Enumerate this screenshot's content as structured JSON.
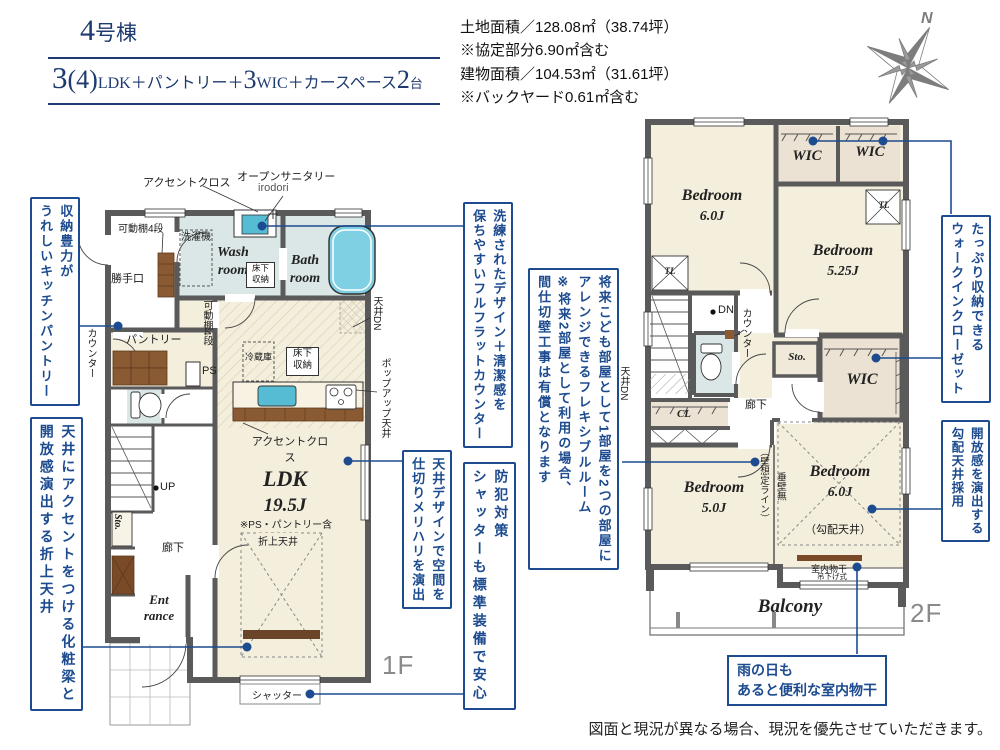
{
  "header": {
    "unit_number": "4",
    "unit_suffix": "号棟",
    "plan": {
      "n1": "3",
      "p": "(4)",
      "t1": "LDK＋パントリー＋",
      "n2": "3",
      "t2": "WIC＋カースペース",
      "n3": "2",
      "t3": "台"
    },
    "area_lines": [
      "土地面積／128.08㎡（38.74坪）",
      "※協定部分6.90㎡含む",
      "建物面積／104.53㎡（31.61坪）",
      "※バックヤード0.61㎡含む"
    ],
    "compass_n": "N"
  },
  "floor1": {
    "label": "1F",
    "accent_cloth_top": "アクセントクロス",
    "open_sanitary": "オープンサニタリー",
    "irodori": "irodori",
    "movable_shelf": "可動棚4段",
    "movable_shelf_v": "可動棚4段",
    "back_door": "勝手口",
    "washer": "洗濯機",
    "wash_room": "Wash\nroom",
    "bath_room": "Bath\nroom",
    "underfloor_storage": "床下\n収納",
    "fridge": "冷蔵庫",
    "pantry": "パントリー",
    "counter_v": "カウンター",
    "ps": "PS",
    "ldk": "LDK",
    "ldk_size": "19.5J",
    "ldk_note": "※PS・パントリー含",
    "accent_cloth_bottom": "アクセントクロス",
    "ceiling_dn": "天井DN",
    "popup_ceiling": "ポップアップ天井",
    "up": "UP",
    "sto": "Sto.",
    "hallway": "廊下",
    "entrance": "Ent\nrance",
    "oriage_ceiling": "折上天井",
    "shutter": "シャッター"
  },
  "floor2": {
    "label": "2F",
    "bed1": "Bedroom",
    "bed1_size": "6.0J",
    "wic": "WIC",
    "bed2": "Bedroom",
    "bed2_size": "5.25J",
    "tl": "TL",
    "dn": "DN",
    "ceiling_dn": "天井DN",
    "counter_v": "カウンター",
    "sto": "Sto.",
    "hallway": "廊下",
    "cl": "CL",
    "bed3": "Bedroom",
    "bed3_size": "5.0J",
    "wall_line": "（壁想定ライン）",
    "tarekabe": "垂壁無",
    "bed4": "Bedroom",
    "bed4_size": "6.0J",
    "slope_ceiling": "（勾配天井）",
    "monohoshi": "室内物干",
    "tsurisage": "吊下げ式",
    "balcony": "Balcony"
  },
  "annotations": {
    "pantry": "収納豊力が\nうれしいキッチンパントリー",
    "beam": "天井にアクセントをつける化粧梁と\n開放感演出する折上天井",
    "fullflat": "洗練されたデザイン＋清潔感を\n保ちやすいフルフラットカウンター",
    "ceiling_design": "天井デザインで空間を\n仕切りメリハリを演出",
    "shutter": "防犯対策\nシャッターも標準装備で安心",
    "flexible": "将来こども部屋として1部屋を2つの部屋に\nアレンジできるフレキシブルルーム\n※将来2部屋として利用の場合、\n間仕切壁工事は有償となります",
    "wic": "たっぷり収納できる\nウォークインクローゼット",
    "slope": "開放感を演出する\n勾配天井採用",
    "rain": "雨の日も\nあると便利な室内物干"
  },
  "footer": {
    "disclaimer": "図面と現況が異なる場合、現況を優先させていただきます。"
  },
  "colors": {
    "accent_navy": "#1d4b8f",
    "title_navy": "#1e3a70",
    "wall_gray": "#5a5a5a",
    "floor_beige": "#f4eedd",
    "wet_blue": "#dbe7e6",
    "closet_tan": "#ece2d4",
    "fixture_blue": "#6ec7db",
    "wood_brown": "#8a5a33",
    "compass_gray": "#7d7d7d"
  }
}
